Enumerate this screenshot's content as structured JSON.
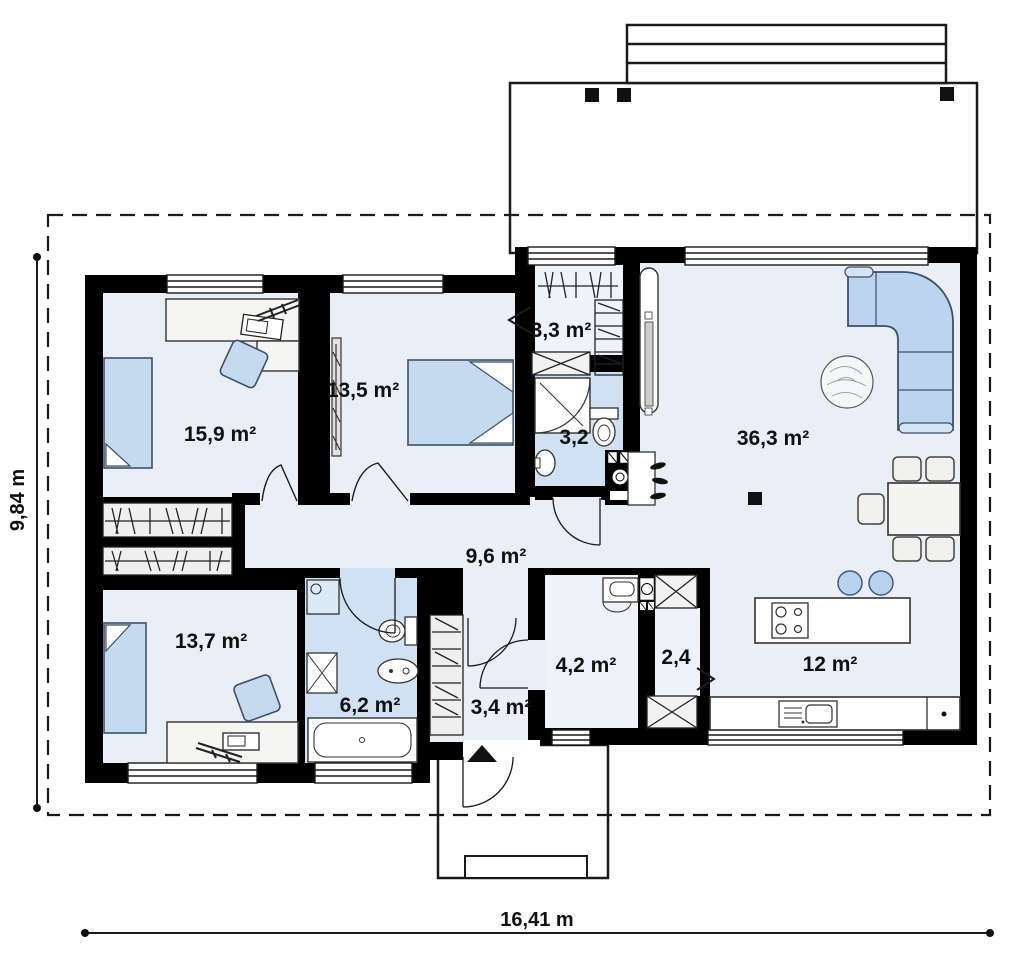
{
  "plan": {
    "type": "single-storey house floor plan",
    "dimensions": {
      "width_label": "16,41 m",
      "depth_label": "9,84 m"
    },
    "rooms": [
      {
        "name": "bedroom-1",
        "label": "15,9 m²"
      },
      {
        "name": "bedroom-2",
        "label": "13,5 m²"
      },
      {
        "name": "wardrobe",
        "label": "3,3 m²"
      },
      {
        "name": "bathroom-small",
        "label": "3,2"
      },
      {
        "name": "living-room",
        "label": "36,3 m²"
      },
      {
        "name": "hall",
        "label": "9,6 m²"
      },
      {
        "name": "bedroom-3",
        "label": "13,7 m²"
      },
      {
        "name": "bathroom-main",
        "label": "6,2 m²"
      },
      {
        "name": "vestibule",
        "label": "3,4 m²"
      },
      {
        "name": "utility",
        "label": "4,2 m²"
      },
      {
        "name": "pantry",
        "label": "2,4"
      },
      {
        "name": "kitchen",
        "label": "12 m²"
      }
    ],
    "colors": {
      "walls": "#000000",
      "room_floor": "#e9eef7",
      "bathroom_floor": "#cfe1f2",
      "furniture_blue": "#bdd4ee",
      "closet_gray": "#efefef"
    }
  }
}
